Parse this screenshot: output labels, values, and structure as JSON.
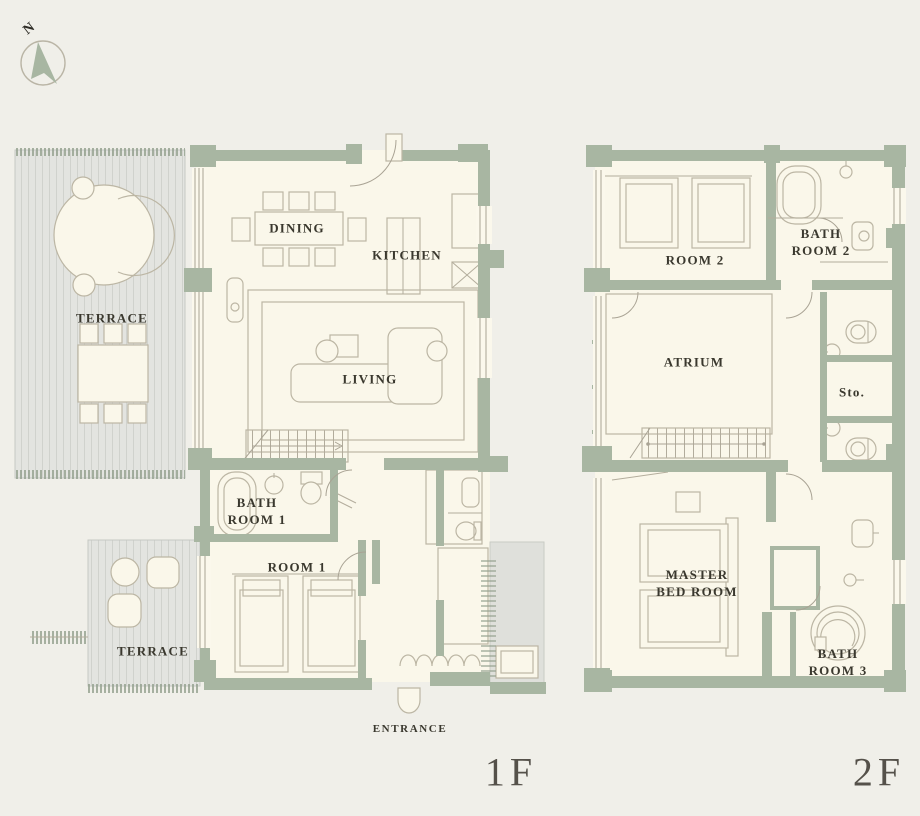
{
  "compass": {
    "label": "N"
  },
  "floor1": {
    "floor_label": "1F",
    "rooms": {
      "terrace_upper": "TERRACE",
      "dining": "DINING",
      "kitchen": "KITCHEN",
      "living": "LIVING",
      "bathroom1": "BATH\nROOM 1",
      "room1": "ROOM 1",
      "terrace_lower": "TERRACE",
      "entrance": "ENTRANCE"
    }
  },
  "floor2": {
    "floor_label": "2F",
    "rooms": {
      "room2": "ROOM 2",
      "bathroom2": "BATH\nROOM 2",
      "atrium": "ATRIUM",
      "storage": "Sto.",
      "master_bedroom": "MASTER\nBED ROOM",
      "bathroom3": "BATH\nROOM 3"
    }
  },
  "colors": {
    "background": "#f0efe9",
    "wall": "#a8b6a2",
    "floor": "#faf7ea",
    "deck": "#e3e4e0",
    "deck_stripe": "#d0d2cd",
    "outline": "#bcb6a4",
    "text": "#3a382e",
    "floor_label_text": "#55514a"
  }
}
